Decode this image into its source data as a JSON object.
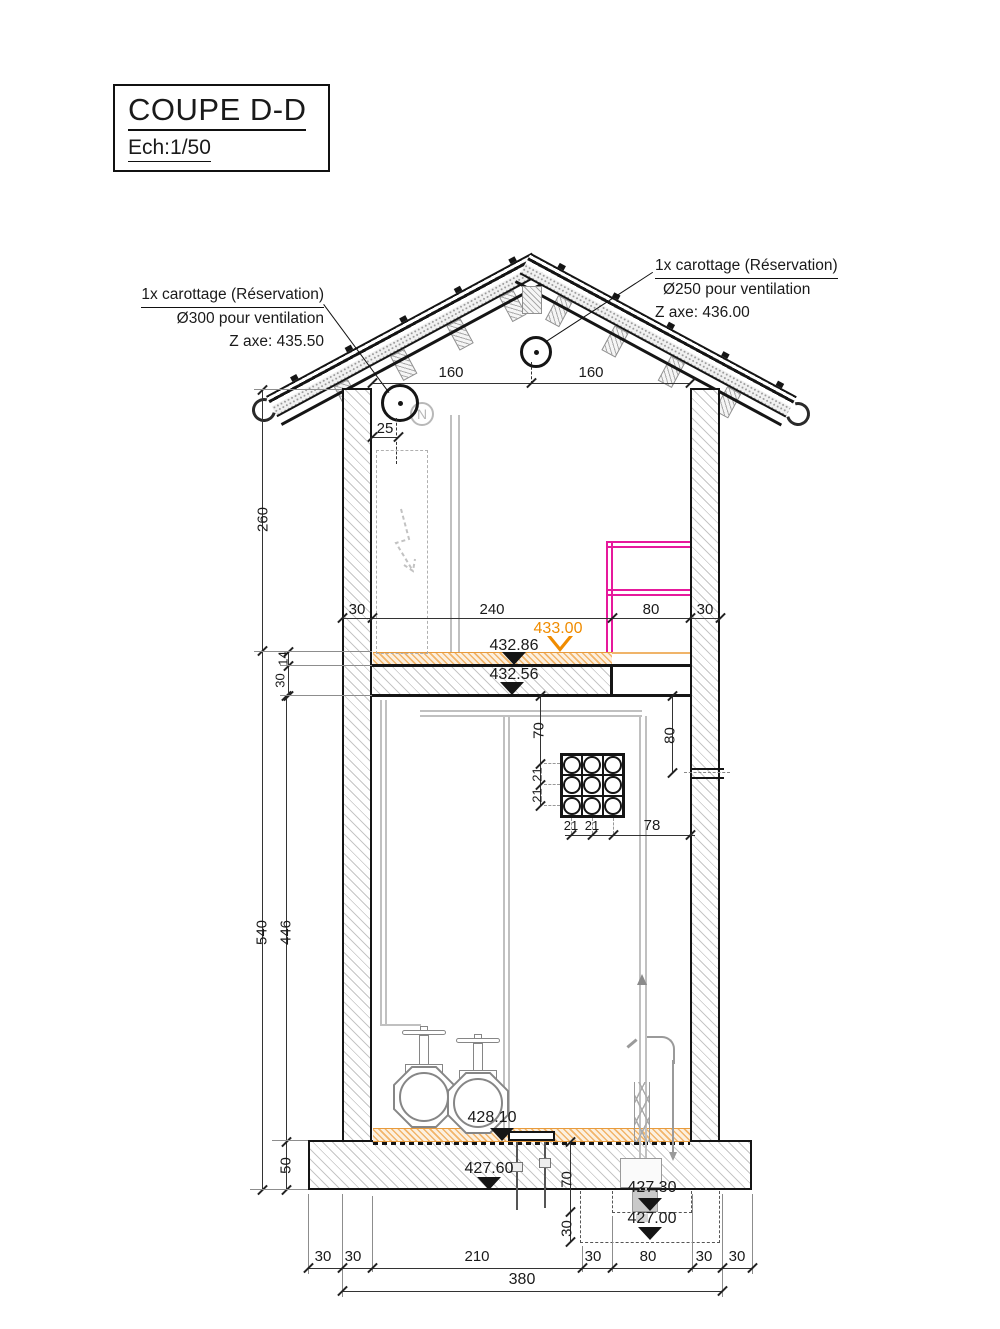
{
  "title_block": {
    "title": "COUPE D-D",
    "scale": "Ech:1/50"
  },
  "annotation_left": {
    "line1": "1x carottage (Réservation)",
    "line2": "Ø300 pour ventilation",
    "line3": "Z axe: 435.50"
  },
  "annotation_right": {
    "line1": "1x carottage (Réservation)",
    "line2": "Ø250 pour ventilation",
    "line3": "Z axe: 436.00"
  },
  "levels": {
    "upper_screed": "433.00",
    "upper_slab": "432.86",
    "upper_ceiling": "432.56",
    "ground_floor": "428.10",
    "slab_bottom": "427.60",
    "pit1": "427.30",
    "pit2": "427.00"
  },
  "dims": {
    "roof_left": "160",
    "roof_right": "160",
    "vent_offset": "25",
    "upper_storey": "260",
    "mid": [
      "30",
      "240",
      "80",
      "30"
    ],
    "screed_thk": "14",
    "slab_thk": "30",
    "grid_top": "70",
    "grid_row1": "21",
    "grid_row2": "21",
    "grid_col1": "21",
    "grid_col2": "21",
    "grid_to_wall": "78",
    "sleeve_drop": "80",
    "total_height": "540",
    "room_height": "446",
    "foundation_thk": "50",
    "pit_depth1": "70",
    "pit_depth2": "30",
    "bottom": [
      "30",
      "30",
      "210",
      "30",
      "80",
      "30",
      "30"
    ],
    "total_width": "380"
  },
  "symbols": {
    "north": "N"
  },
  "colors": {
    "level_accent": "#f08c00",
    "screed_orange": "#e89b3c",
    "duct_magenta": "#e6199c",
    "line": "#1a1a1a",
    "hatch_grey": "#c6c6c6"
  }
}
